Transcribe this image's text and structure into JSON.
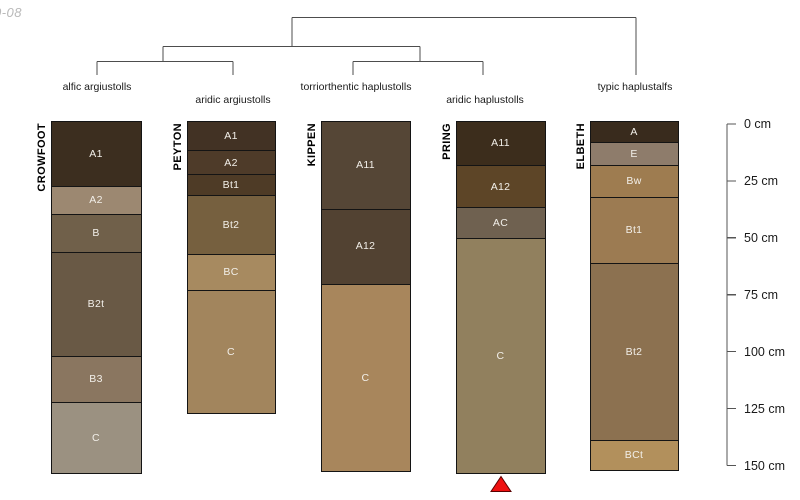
{
  "watermark": "0-08",
  "dendrogram": {
    "leaves": [
      {
        "label": "alfic argiustolls",
        "x": 97,
        "label_row": 1
      },
      {
        "label": "aridic argiustolls",
        "x": 233,
        "label_row": 2
      },
      {
        "label": "torriorthentic haplustolls",
        "x": 356,
        "label_row": 1
      },
      {
        "label": "aridic haplustolls",
        "x": 485,
        "label_row": 2
      },
      {
        "label": "typic haplustalfs",
        "x": 635,
        "label_row": 1
      }
    ]
  },
  "depth_scale": {
    "unit": "cm",
    "ticks": [
      {
        "cm": 0,
        "label": "0 cm"
      },
      {
        "cm": 25,
        "label": "25 cm"
      },
      {
        "cm": 50,
        "label": "50 cm"
      },
      {
        "cm": 75,
        "label": "75 cm"
      },
      {
        "cm": 100,
        "label": "100 cm"
      },
      {
        "cm": 125,
        "label": "125 cm"
      },
      {
        "cm": 150,
        "label": "150 cm"
      }
    ]
  },
  "profiles": [
    {
      "name": "CROWFOOT",
      "taxon": "alfic argiustolls",
      "x": 52,
      "width": 89,
      "horizons": [
        {
          "name": "A1",
          "top_cm": 0,
          "bottom_cm": 28,
          "color": "#3c2e1f"
        },
        {
          "name": "A2",
          "top_cm": 28,
          "bottom_cm": 40.5,
          "color": "#9c8871"
        },
        {
          "name": "B",
          "top_cm": 40.5,
          "bottom_cm": 57,
          "color": "#70604a"
        },
        {
          "name": "B2t",
          "top_cm": 57,
          "bottom_cm": 103,
          "color": "#695945"
        },
        {
          "name": "B3",
          "top_cm": 103,
          "bottom_cm": 123,
          "color": "#8a7660"
        },
        {
          "name": "C",
          "top_cm": 123,
          "bottom_cm": 154,
          "color": "#9b9181"
        }
      ]
    },
    {
      "name": "PEYTON",
      "taxon": "aridic argiustolls",
      "x": 188,
      "width": 87,
      "horizons": [
        {
          "name": "A1",
          "top_cm": 0,
          "bottom_cm": 12.5,
          "color": "#423224"
        },
        {
          "name": "A2",
          "top_cm": 12.5,
          "bottom_cm": 23,
          "color": "#4e3b29"
        },
        {
          "name": "Bt1",
          "top_cm": 23,
          "bottom_cm": 32,
          "color": "#4e3b26"
        },
        {
          "name": "Bt2",
          "top_cm": 32,
          "bottom_cm": 58,
          "color": "#76603f"
        },
        {
          "name": "BC",
          "top_cm": 58,
          "bottom_cm": 74,
          "color": "#a78a60"
        },
        {
          "name": "C",
          "top_cm": 74,
          "bottom_cm": 128,
          "color": "#a2855d"
        }
      ]
    },
    {
      "name": "KIPPEN",
      "taxon": "torriorthentic haplustolls",
      "x": 322,
      "width": 88,
      "horizons": [
        {
          "name": "A11",
          "top_cm": 0,
          "bottom_cm": 38,
          "color": "#554636"
        },
        {
          "name": "A12",
          "top_cm": 38,
          "bottom_cm": 71,
          "color": "#524232"
        },
        {
          "name": "C",
          "top_cm": 71,
          "bottom_cm": 153.5,
          "color": "#a8865c"
        }
      ]
    },
    {
      "name": "PRING",
      "taxon": "aridic haplustolls",
      "x": 457,
      "width": 88,
      "horizons": [
        {
          "name": "A11",
          "top_cm": 0,
          "bottom_cm": 19,
          "color": "#3c2d1c"
        },
        {
          "name": "A12",
          "top_cm": 19,
          "bottom_cm": 37.5,
          "color": "#5d4527"
        },
        {
          "name": "AC",
          "top_cm": 37.5,
          "bottom_cm": 51,
          "color": "#6f6150"
        },
        {
          "name": "C",
          "top_cm": 51,
          "bottom_cm": 154,
          "color": "#91805e"
        }
      ]
    },
    {
      "name": "ELBETH",
      "taxon": "typic haplustalfs",
      "x": 591,
      "width": 87,
      "horizons": [
        {
          "name": "A",
          "top_cm": 0,
          "bottom_cm": 9,
          "color": "#392b1d"
        },
        {
          "name": "E",
          "top_cm": 9,
          "bottom_cm": 19,
          "color": "#8e7c6b"
        },
        {
          "name": "Bw",
          "top_cm": 19,
          "bottom_cm": 33,
          "color": "#9e7c50"
        },
        {
          "name": "Bt1",
          "top_cm": 33,
          "bottom_cm": 62,
          "color": "#9c7b52"
        },
        {
          "name": "Bt2",
          "top_cm": 62,
          "bottom_cm": 139.5,
          "color": "#8c7150"
        },
        {
          "name": "BCt",
          "top_cm": 139.5,
          "bottom_cm": 153,
          "color": "#b2905c"
        }
      ]
    }
  ],
  "marker": {
    "shape": "triangle-up",
    "under_profile": "PRING",
    "color": "#ee1010"
  },
  "colors": {
    "background": "#ffffff",
    "tree_line": "#4d4d4d",
    "scale_line": "#555555",
    "horizon_border": "#141414",
    "horizon_label_text": "#f2efe9",
    "marker_red": "#ee1010"
  }
}
